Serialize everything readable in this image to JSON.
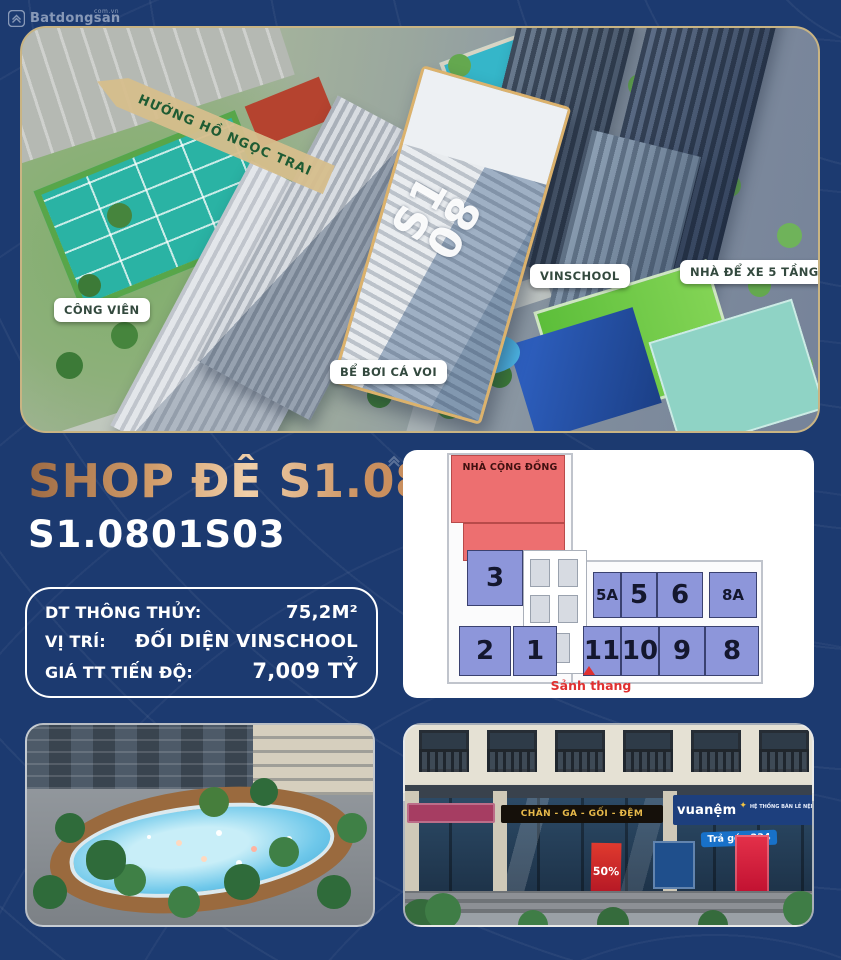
{
  "watermark": {
    "brand": "Batdongsan",
    "suffix": "com.vn"
  },
  "aerial": {
    "direction_arrow": "HƯỚNG HỒ NGỌC TRAI",
    "tower_label_line1": "S1",
    "tower_label_line2": "08",
    "tags": {
      "park": "CÔNG VIÊN",
      "whale_pool": "BỂ BƠI CÁ VOI",
      "school": "VINSCHOOL",
      "parking": "NHÀ ĐỂ XE 5 TẦNG"
    }
  },
  "listing": {
    "title": "SHOP ĐẾ S1.08",
    "unit_code": "S1.0801S03",
    "specs": [
      {
        "label": "DT THÔNG THỦY:",
        "value": "75,2M²"
      },
      {
        "label": "VỊ TRÍ:",
        "value": "ĐỐI DIỆN VINSCHOOL"
      },
      {
        "label": "GIÁ TT TIẾN ĐỘ:",
        "value": "7,009 TỶ"
      }
    ]
  },
  "floorplan": {
    "community_house": "NHÀ CỘNG ĐỒNG",
    "lobby": "Sảnh thang",
    "units": [
      "3",
      "2",
      "1",
      "5A",
      "5",
      "6",
      "8A",
      "11",
      "10",
      "9",
      "8"
    ]
  },
  "storefront": {
    "black_sign": "CHĂN - GA - GỐI - ĐỆM",
    "brand_sign": "vuanệm",
    "brand_slogan": "HỆ THỐNG BÁN LẺ NỆM & CHĂN GA GỐI",
    "brand_phone": "1800 2092",
    "installment_banner": "Trả góp 234",
    "discount_poster": "50%"
  },
  "colors": {
    "background": "#1c3a70",
    "title_copper": "#d9a877",
    "plan_unit_blue": "#8d96da",
    "plan_community_red": "#ed6f70",
    "tag_text_green": "#33493e",
    "arrow_tan": "#d6be8c"
  }
}
